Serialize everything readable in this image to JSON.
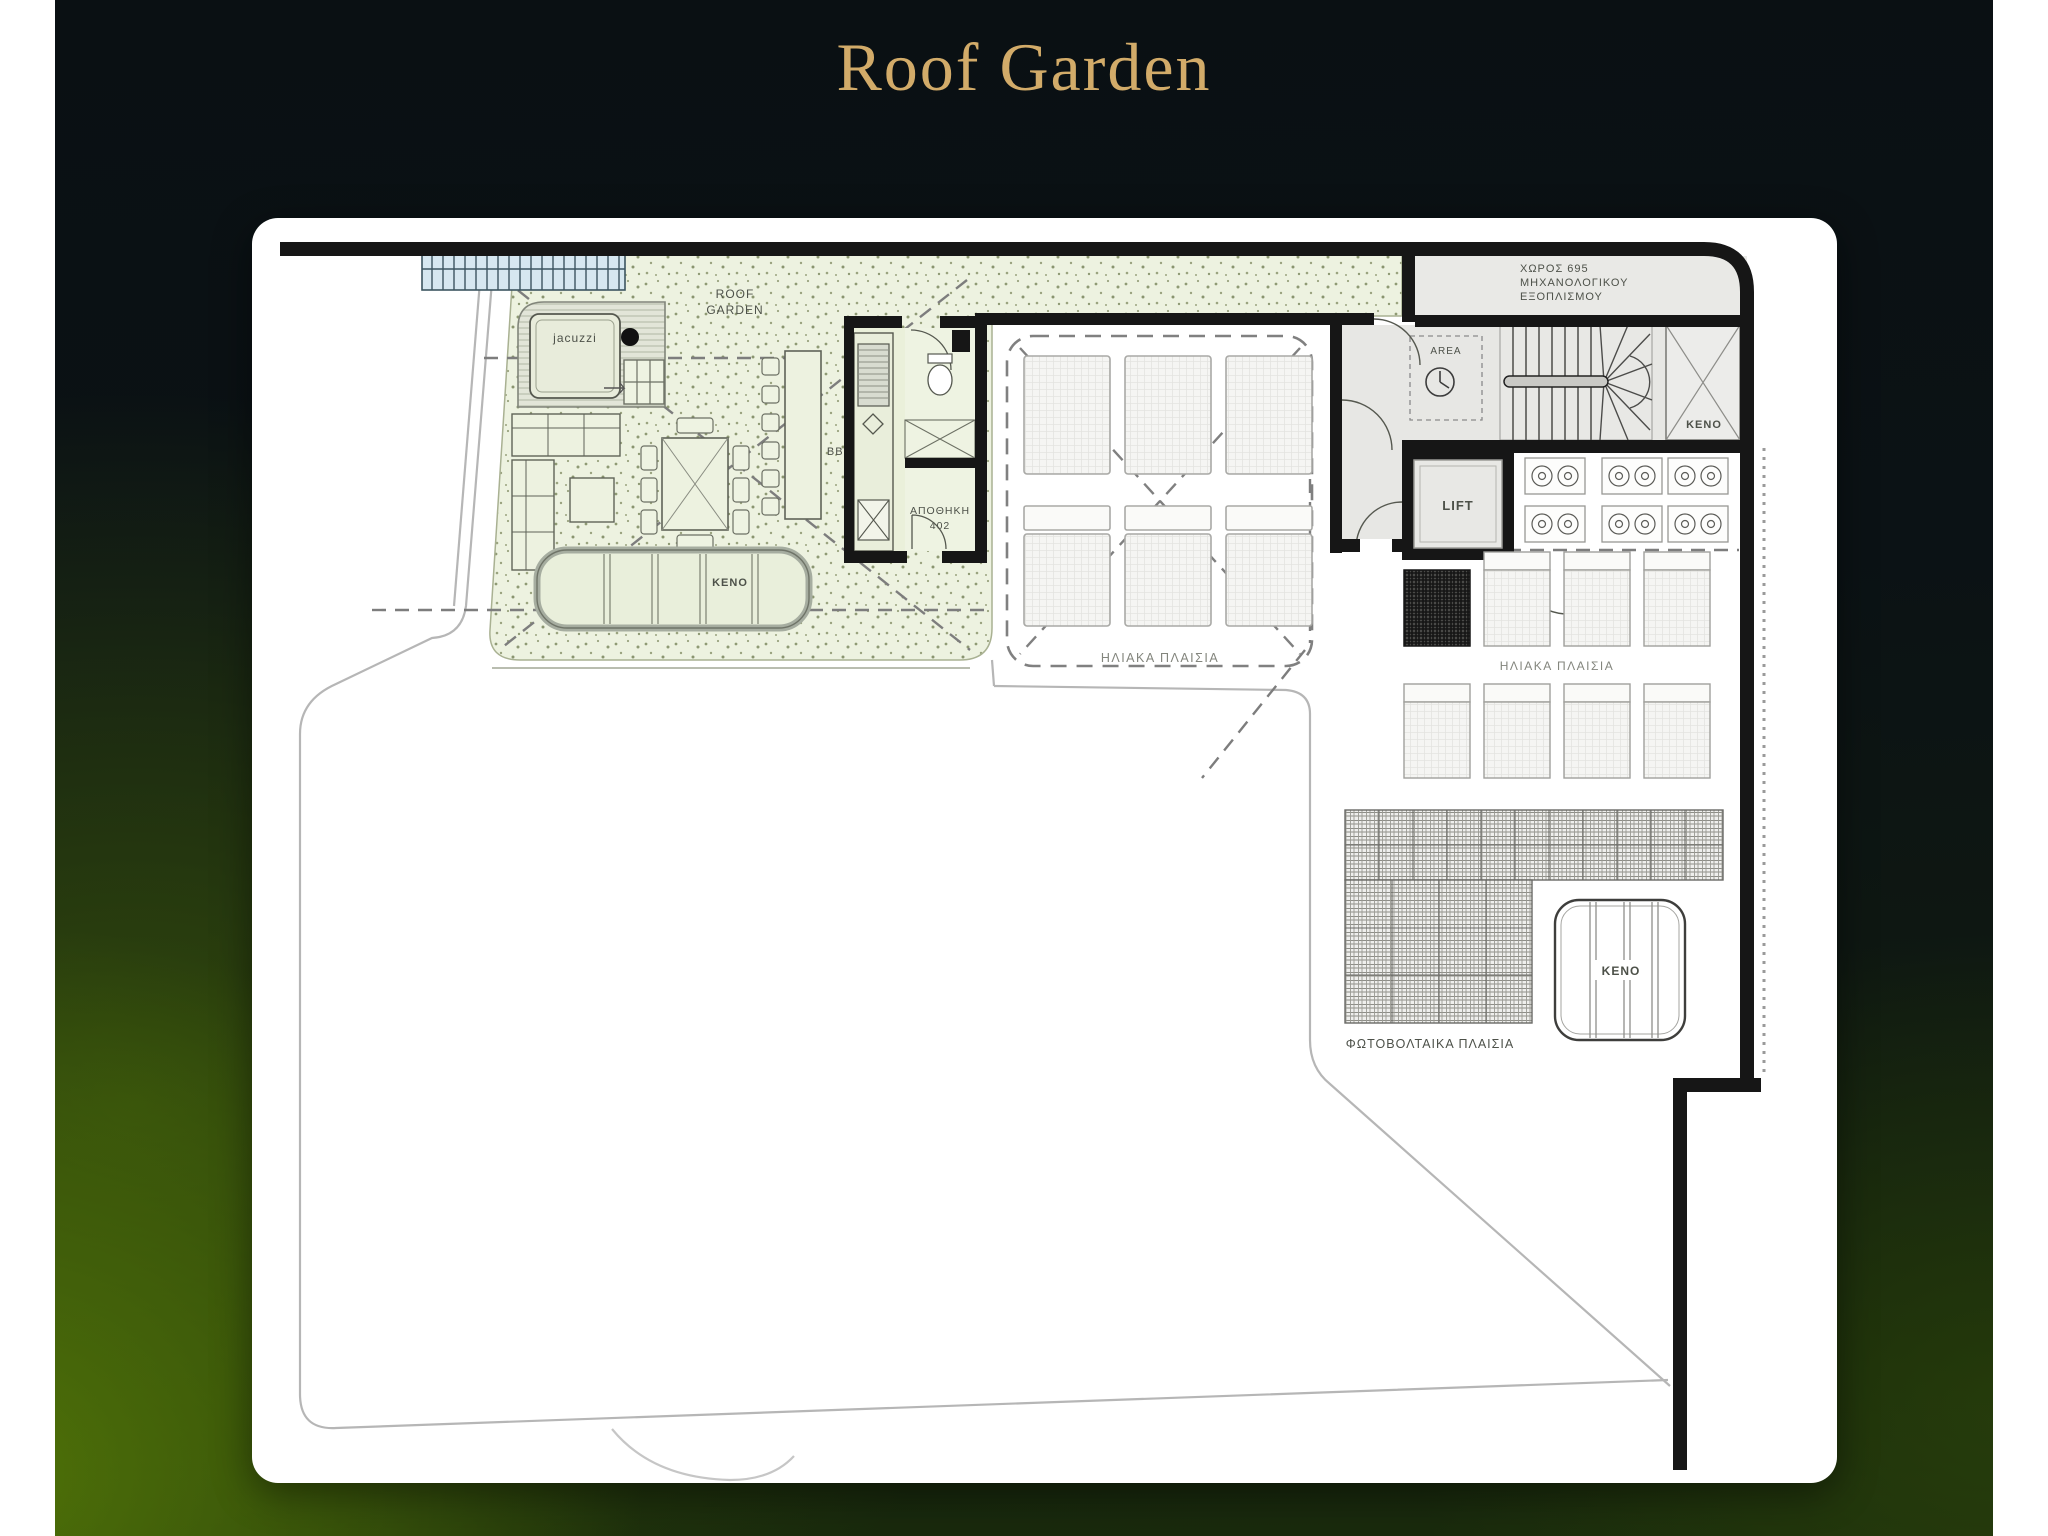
{
  "page": {
    "title": "Roof Garden"
  },
  "plan": {
    "labels": {
      "roof_garden_line1": "ROOF",
      "roof_garden_line2": "GARDEN",
      "jacuzzi": "jacuzzi",
      "bbq": "BBQ",
      "storage_line1": "ΑΠΟΘΗΚΗ",
      "storage_line2": "402",
      "keno_planter": "KENO",
      "solar_mid": "ΗΛΙΑΚΑ ΠΛΑΙΣΙΑ",
      "area": "AREA",
      "keno_stair": "KENO",
      "lift": "LIFT",
      "mech_line1": "ΧΩΡΟΣ 695",
      "mech_line2": "ΜΗΧΑΝΟΛΟΓΙΚΟΥ",
      "mech_line3": "ΕΞΟΠΛΙΣΜΟΥ",
      "solar_right": "ΗΛΙΑΚΑ ΠΛΑΙΣΙΑ",
      "pv": "ΦΩΤΟΒΟΛΤΑΙΚΑ ΠΛΑΙΣΙΑ",
      "keno_bottom": "KENO"
    },
    "colors": {
      "title_gold": "#d2ab69",
      "background_dark": "#0b1215",
      "background_green": "#3f5a0a",
      "garden_fill": "#edf2e0",
      "wall": "#161616",
      "room_gray": "#e7e7e4",
      "pergola_blue": "#d6e7f0"
    }
  }
}
